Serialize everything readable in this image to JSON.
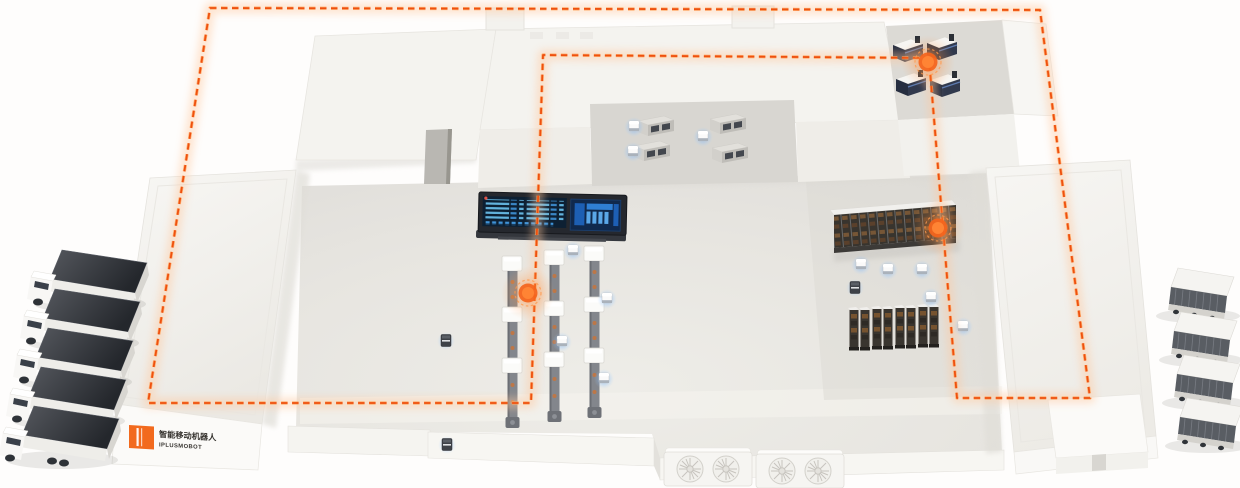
{
  "scene": {
    "type": "isometric-smart-factory-illustration",
    "background": "#fefdfc",
    "accent_orange": "#f2571b",
    "agv_glow_blue": "#5aa9ff"
  },
  "brand": {
    "logo_mark_color": "#f26a1e",
    "name_cn": "智能移动机器人",
    "name_en": "IPLUSMOBOT"
  },
  "route": {
    "style": "dashed-loop",
    "closed": true,
    "color": "#ee500f",
    "glow_color": "#ffa35c",
    "dash": "6.5 4.5",
    "points": [
      [
        210,
        8
      ],
      [
        1040,
        10
      ],
      [
        1090,
        398
      ],
      [
        957,
        398
      ],
      [
        929,
        58
      ],
      [
        543,
        55
      ],
      [
        531,
        403
      ],
      [
        148,
        403
      ]
    ]
  },
  "counts": {
    "trucks_left": 5,
    "carriers_right": 4,
    "production_lines": 3,
    "waypoints": 3,
    "agvs_white": 12,
    "robots_dark": 3,
    "test_rack_towers": 8,
    "test_machines": 4,
    "buffer_machines": 4,
    "hvac_units": 2
  },
  "instances": [
    {
      "layer": "trucks-left",
      "def": "truck",
      "name": "truck",
      "items": [
        [
          28,
          248
        ],
        [
          21,
          287
        ],
        [
          14,
          326
        ],
        [
          7,
          365
        ],
        [
          0,
          404
        ]
      ]
    },
    {
      "layer": "carriers-right",
      "def": "carrier",
      "name": "autonomous-carrier",
      "items": [
        [
          1150,
          268
        ],
        [
          1153,
          312
        ],
        [
          1156,
          355
        ],
        [
          1159,
          398
        ]
      ]
    },
    {
      "layer": "prod",
      "def": "prod-line",
      "name": "production-line",
      "items": [
        [
          502,
          256
        ],
        [
          544,
          250
        ],
        [
          584,
          246
        ]
      ]
    },
    {
      "layer": "racktowers",
      "def": "rack-tower",
      "name": "rack-tower",
      "items": [
        [
          848,
          304
        ],
        [
          859,
          304
        ],
        [
          871,
          303
        ],
        [
          882,
          303
        ],
        [
          894,
          302
        ],
        [
          905,
          302
        ],
        [
          917,
          301
        ],
        [
          928,
          301
        ]
      ]
    },
    {
      "layer": "machines-tr",
      "def": "machine-tr",
      "name": "test-machine",
      "items": [
        [
          891,
          36
        ],
        [
          925,
          34
        ],
        [
          894,
          70
        ],
        [
          928,
          71
        ]
      ]
    },
    {
      "layer": "machines-mz",
      "def": "machine-mz",
      "name": "buffer-machine",
      "items": [
        [
          638,
          116
        ],
        [
          710,
          114
        ],
        [
          634,
          141
        ],
        [
          712,
          143
        ]
      ]
    },
    {
      "layer": "fans",
      "def": "fan-block",
      "name": "hvac-unit",
      "items": [
        [
          664,
          448
        ],
        [
          756,
          450
        ]
      ]
    },
    {
      "layer": "agv-white",
      "def": "agv-white",
      "name": "agv",
      "items": [
        [
          573,
          251
        ],
        [
          607,
          299
        ],
        [
          562,
          342
        ],
        [
          604,
          379
        ],
        [
          634,
          127
        ],
        [
          703,
          137
        ],
        [
          633,
          152
        ],
        [
          888,
          270
        ],
        [
          922,
          270
        ],
        [
          861,
          265
        ],
        [
          931,
          298
        ],
        [
          963,
          327
        ]
      ]
    },
    {
      "layer": "agv-dark",
      "def": "agv-dark",
      "name": "service-robot",
      "items": [
        [
          446,
          341
        ],
        [
          447,
          445
        ],
        [
          855,
          288
        ]
      ]
    },
    {
      "layer": "waypoints",
      "def": "waypoint",
      "name": "route-waypoint",
      "items": [
        [
          528,
          293
        ],
        [
          938,
          228
        ],
        [
          928,
          62
        ]
      ]
    }
  ]
}
